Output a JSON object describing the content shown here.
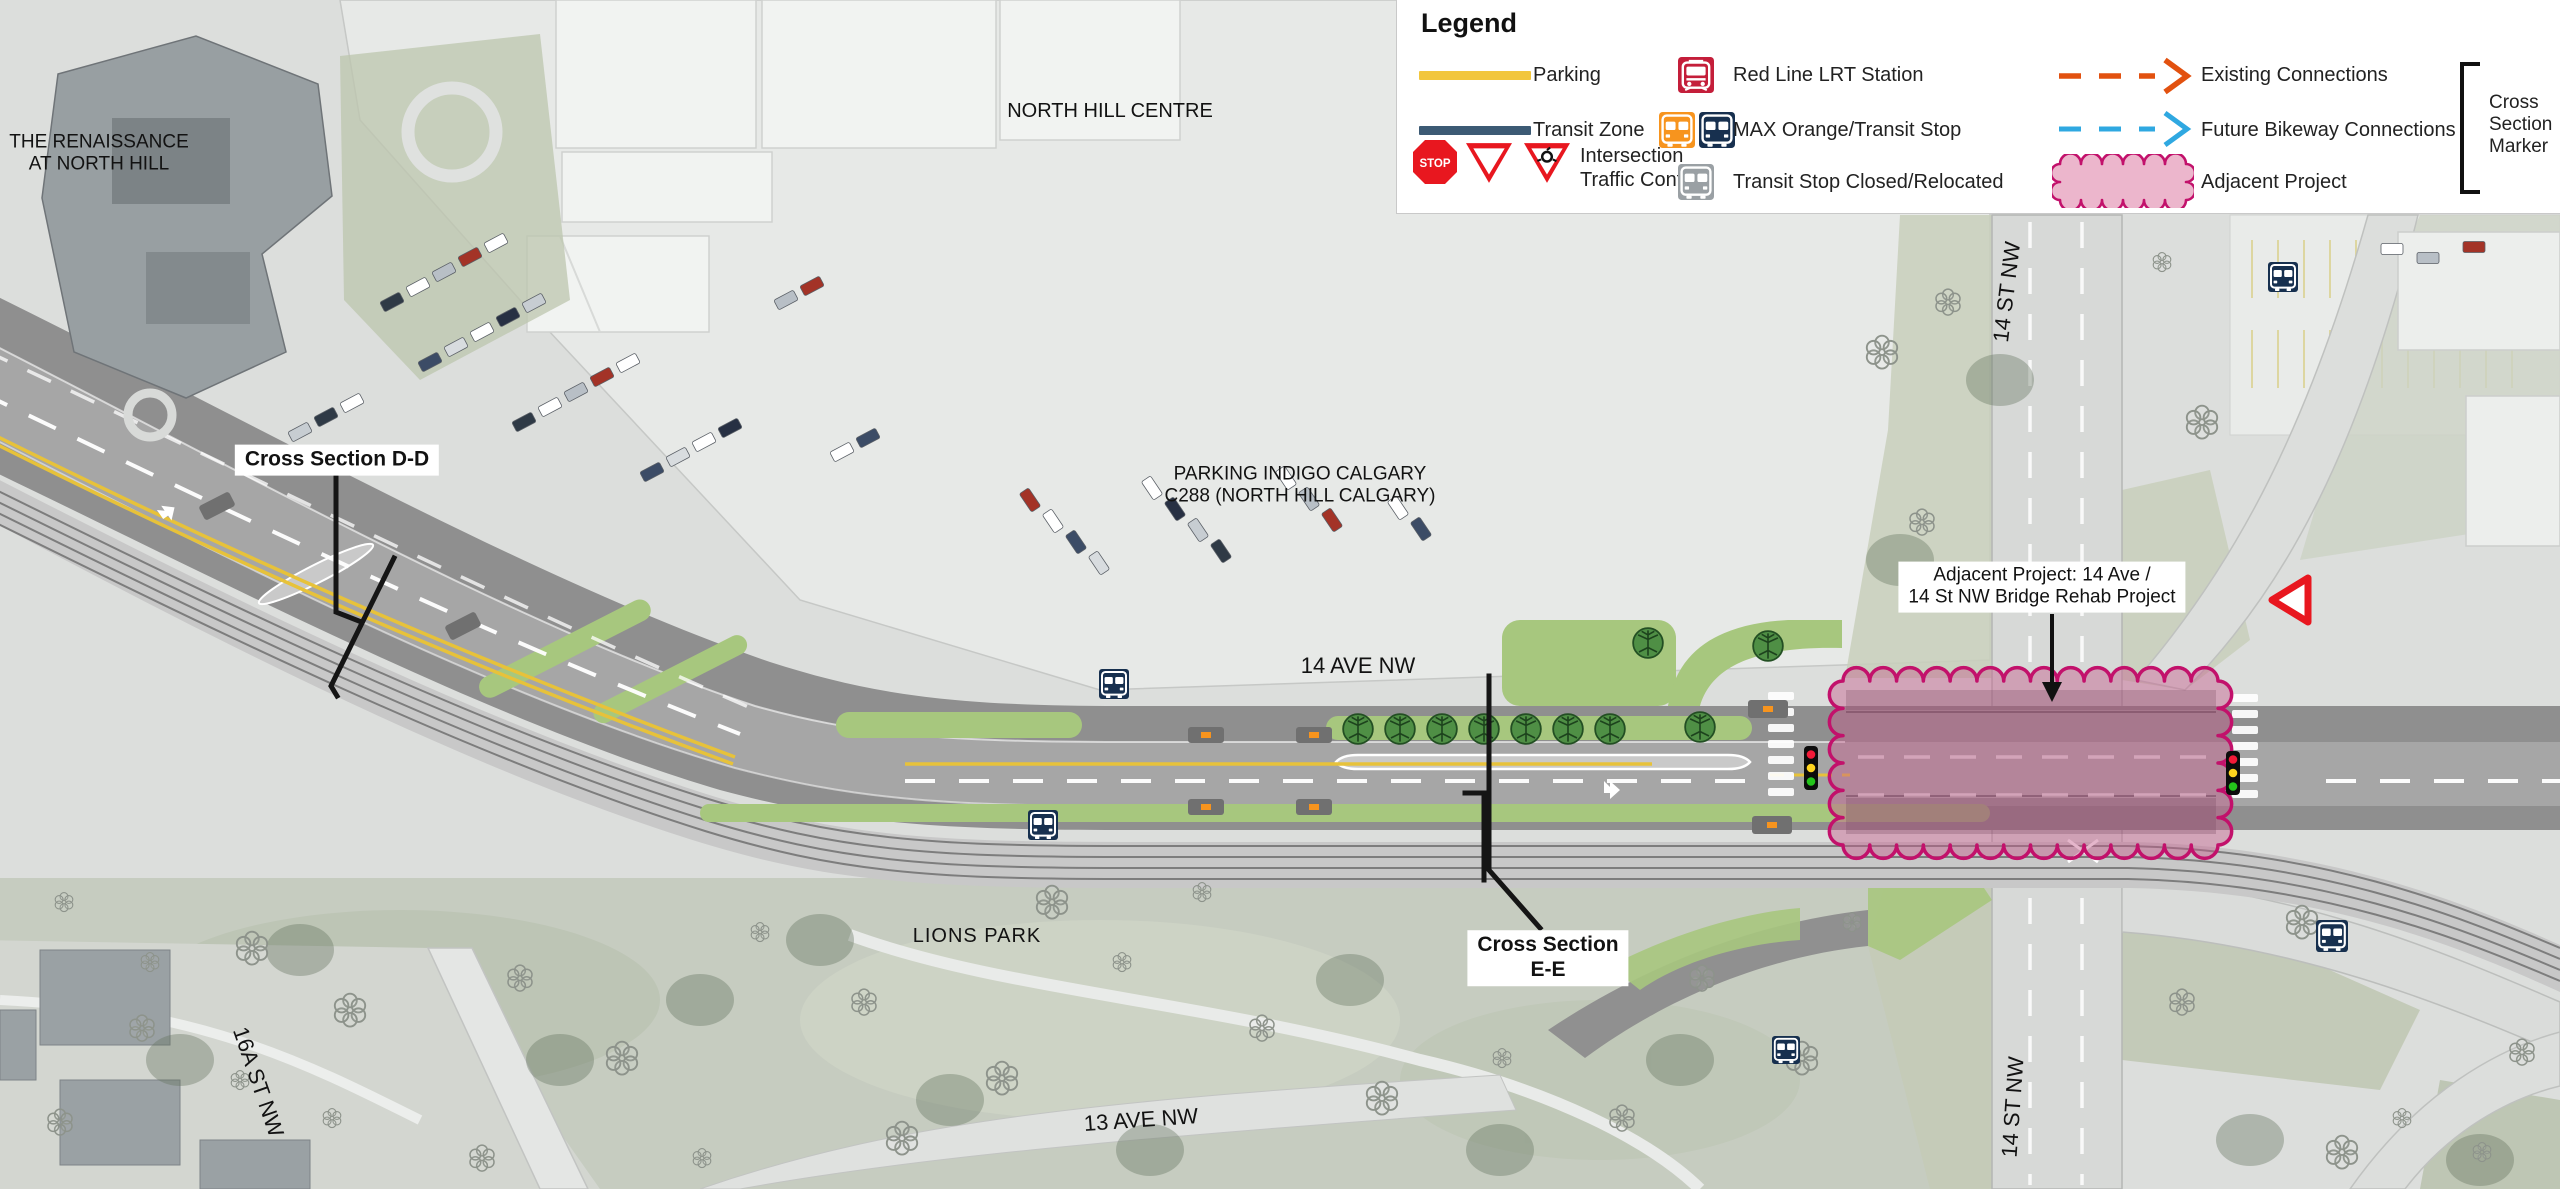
{
  "legend": {
    "title": "Legend",
    "stop_sign_text": "STOP",
    "items": {
      "parking": "Parking",
      "transit_zone": "Transit Zone",
      "intersection_traffic_control": "Intersection Traffic Control",
      "red_line_lrt": "Red Line LRT Station",
      "max_orange": "MAX Orange/Transit Stop",
      "transit_stop_closed": "Transit Stop Closed/Relocated",
      "existing_connections": "Existing Connections",
      "future_bikeway": "Future Bikeway Connections",
      "adjacent_project": "Adjacent Project",
      "cross_section_marker": "Cross Section Marker"
    }
  },
  "map_labels": {
    "renaissance_l1": "THE RENAISSANCE",
    "renaissance_l2": "AT NORTH HILL",
    "north_hill_centre": "NORTH HILL CENTRE",
    "cross_section_dd": "Cross Section D-D",
    "parking_indigo_l1": "PARKING INDIGO CALGARY",
    "parking_indigo_l2": "C288 (NORTH HILL CALGARY)",
    "ave_14": "14 AVE NW",
    "adjacent_project_l1": "Adjacent Project: 14 Ave /",
    "adjacent_project_l2": "14 St NW Bridge Rehab Project",
    "st_14_top": "14 ST NW",
    "st_14_bottom": "14 ST NW",
    "lions_park": "LIONS PARK",
    "cross_section_ee_l1": "Cross Section",
    "cross_section_ee_l2": "E-E",
    "st_16a": "16A ST NW",
    "ave_13": "13 AVE NW"
  },
  "colors": {
    "parking_yellow": "#F2C63D",
    "transit_zone_navy": "#3C5A74",
    "bus_navy": "#17304F",
    "lrt_red": "#C41E3A",
    "max_orange": "#F7941E",
    "closed_gray": "#9AA0A4",
    "existing_orange": "#E2510F",
    "future_blue": "#2FA8E1",
    "adjacent_pink_stroke": "#C2116B",
    "signal_red": "#F31A38",
    "signal_yellow": "#FFD51E",
    "signal_green": "#24C41B",
    "green_strip": "#A7C77E"
  }
}
